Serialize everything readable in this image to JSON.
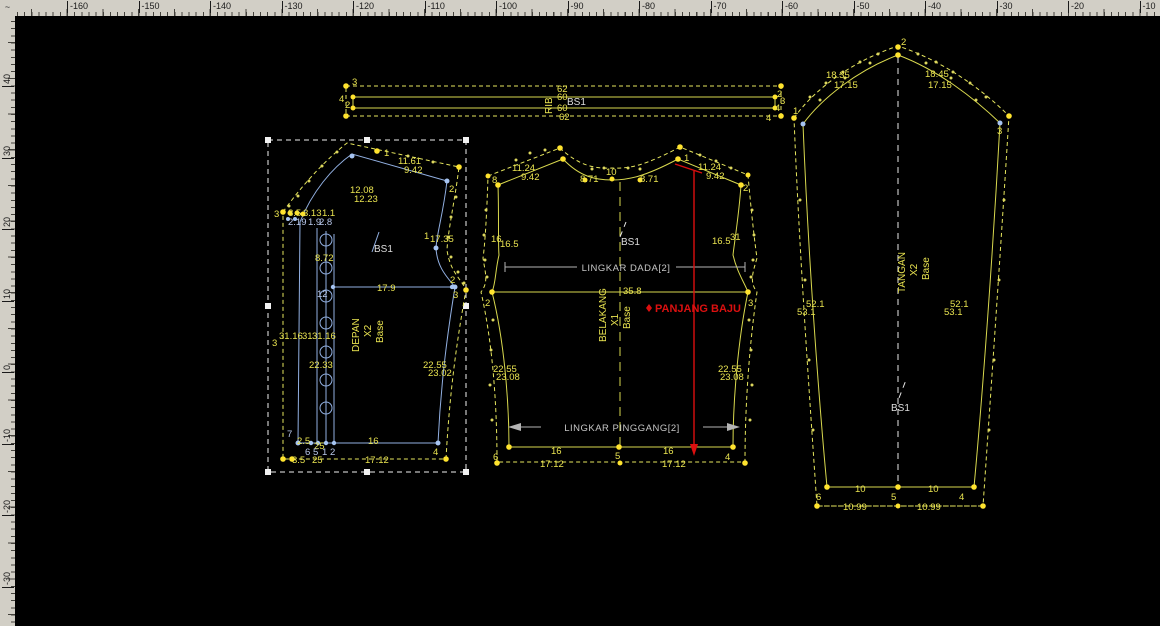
{
  "rulers": {
    "corner_glyph": "~",
    "top": {
      "unit_labels": [
        "-160",
        "-150",
        "-140",
        "-130",
        "-120",
        "-110",
        "-100",
        "-90",
        "-80",
        "-70",
        "-60",
        "-50",
        "-40",
        "-30",
        "-20",
        "-10"
      ]
    },
    "left": {
      "unit_labels": [
        "40",
        "30",
        "20",
        "10",
        "0",
        "-10",
        "-20",
        "-30"
      ]
    }
  },
  "colors": {
    "pattern_yellow": "#d9d94e",
    "pattern_blue": "#92b0e2",
    "measure_red": "#dc0f0f",
    "dot_yellow": "#ffe32e",
    "canvas": "#000000",
    "ruler": "#d2cfc6"
  },
  "pieces": {
    "rib": {
      "name": "RIB",
      "base": "BS1",
      "width_cut_top": "62",
      "width_sew_top": "60",
      "width_sew_bottom": "60",
      "width_cut_bottom": "62",
      "pt_top_left": "3",
      "pt_left_a": "4",
      "pt_left_b": "2",
      "pt_right_a": "2",
      "pt_right_b": "3",
      "pt_right_c": "4",
      "pt_bottom_right": "4"
    },
    "depan": {
      "name": "DEPAN",
      "qty": "X2",
      "base_label": "Base",
      "base": "BS1",
      "pt_1": "1",
      "pt_2": "2",
      "pt_1b": "1",
      "pt_2r": "2",
      "pt_3r": "3",
      "pt_3l": "3",
      "pt_7": "7",
      "pt_6": "6",
      "pt_5": "5",
      "pt_1c": "1",
      "pt_2c": "2",
      "pt_4": "4",
      "pt_12": "12",
      "shoulder_cut": "11.61",
      "shoulder": "9.42",
      "neck_cut": "12.08",
      "neck": "12.23",
      "armhole": "17.35",
      "cluster_a": "8.5",
      "cluster_b": "3.13",
      "cluster_c": "1.1",
      "cluster_d": "2.19",
      "cluster_e": "1.9",
      "cluster_f": "2.8",
      "placket_w": "8.72",
      "chest": "17.9",
      "cf_len_a": "31.16",
      "cf_len_b": "31",
      "cf_len_c": "31.16",
      "waist_len": "22.33",
      "side_cut": "22.55",
      "side": "23.02",
      "hem_a": "2.5",
      "hem_b": "25",
      "hem": "16",
      "hem_cut_a": "3.5",
      "hem_cut_b": "25",
      "hem_cut": "17.12"
    },
    "belakang": {
      "name": "BELAKANG",
      "qty": "X1",
      "base_label": "Base",
      "base": "BS1",
      "pt_8": "8",
      "pt_10": "10",
      "pt_1": "1",
      "pt_2r": "2",
      "pt_2l": "2",
      "pt_3r": "3",
      "pt_6": "6",
      "pt_5": "5",
      "pt_4": "4",
      "pt_31": "31",
      "shoulder_cut_l": "11.24",
      "shoulder_l": "9.42",
      "neck_l": "8.71",
      "neck_r": "8.71",
      "shoulder_cut_r": "11.24",
      "shoulder_r": "9.42",
      "side_cut_l": "16",
      "side_l": "16.5",
      "side_r": "16.5",
      "chest": "35.8",
      "waist_cut_l": "22.55",
      "waist_l": "23.08",
      "waist_cut_r": "22.55",
      "waist_r": "23.08",
      "hem_l": "16",
      "hem_r": "16",
      "hem_cut_l": "17.12",
      "hem_cut_r": "17.12",
      "lingkar_dada": "LINGKAR DADA[2]",
      "lingkar_pinggang": "LINGKAR PINGGANG[2]",
      "panjang_baju": "PANJANG BAJU"
    },
    "tangan": {
      "name": "TANGAN",
      "qty": "X2",
      "base_label": "Base",
      "base": "BS1",
      "pt_2": "2",
      "pt_1": "1",
      "pt_3": "3",
      "pt_6": "6",
      "pt_5": "5",
      "pt_4": "4",
      "cap_cut_l": "18.35",
      "cap_l": "17.15",
      "cap_cut_r": "18.45",
      "cap_r": "17.15",
      "side_l": "52.1",
      "side_l2": "53.1",
      "side_r": "52.1",
      "side_r2": "53.1",
      "hem_l": "10",
      "hem_r": "10",
      "hem_cut_l": "10.99",
      "hem_cut_r": "10.99"
    }
  }
}
